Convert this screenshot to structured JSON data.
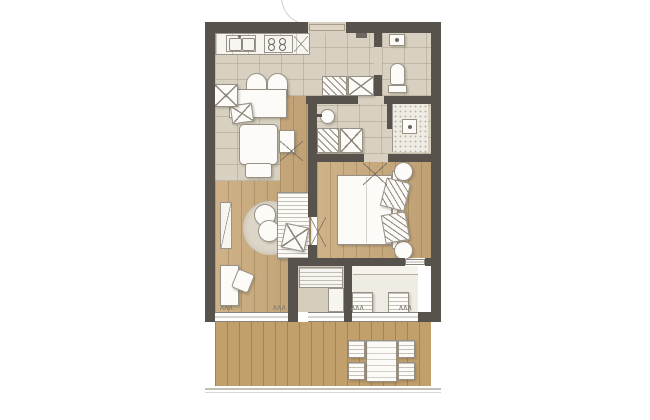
{
  "document": {
    "type": "architectural floor plan",
    "style": "hand-rendered watercolor apartment plan, no text labels",
    "orientation": "entry at top, terrace at bottom"
  },
  "palette": {
    "background": "#ffffff",
    "wall": "#57524b",
    "wood_floor": "#c9a97a",
    "wood_grain": "#7a5e32",
    "deck": "#c2a06c",
    "stone_tile": "#d8d1c1",
    "tile_grout": "#948a74",
    "furniture_fill": "#fcfbf8",
    "furniture_outline": "#969085",
    "rug": "#dcd6c9",
    "shadow": "rgba(80,70,55,0.28)"
  },
  "rooms": {
    "kitchen": {
      "name": "Kitchen with counter, double sink and 4-burner cooktop",
      "floor": "stone tile"
    },
    "dining": {
      "name": "Dining corner with table and arch-back chairs",
      "floor": "stone tile"
    },
    "hall": {
      "name": "Entry hall with built-in closets",
      "floor": "stone tile"
    },
    "wc": {
      "name": "WC with toilet and hand basin",
      "floor": "stone tile"
    },
    "bathroom": {
      "name": "Bathroom with washbasin, walk-in shower and wardrobes",
      "floor": "stone tile"
    },
    "living": {
      "name": "Living room with armchair, daybed, round rug, poufs and desk",
      "floor": "wood plank"
    },
    "bedroom": {
      "name": "Bedroom with double bed, pillows and round nightstands",
      "floor": "wood plank"
    },
    "utility": {
      "name": "Utility / storage room with louvered cabinet",
      "floor": "stone tile"
    },
    "loggia": {
      "name": "Loggia with two folding chairs",
      "floor": "pale screed"
    },
    "terrace": {
      "name": "Terrace deck with outdoor dining table and four chairs",
      "floor": "timber deck"
    }
  },
  "furniture_counts": {
    "closet_x_symbols": 4,
    "hatched_closets": 2,
    "door_swing_marks": 3,
    "window_zigzag_marks": 4,
    "bed_pillows": 2,
    "nightstands": 2,
    "poufs": 2,
    "outdoor_chairs": 4,
    "loggia_chairs": 2
  },
  "openings": {
    "entry_door": "top wall, outward swing arc",
    "wc_door": "left jamb of WC",
    "bath_passage": "hall through bathroom to bedroom",
    "living_bedroom_door": "cross-marked opening in partition",
    "bedroom_loggia_glass": "glazed slot in bottom bedroom wall",
    "south_glazing": "full-width window band onto terrace"
  },
  "marks": {
    "zigzag_glyph": "∧∧∧"
  }
}
